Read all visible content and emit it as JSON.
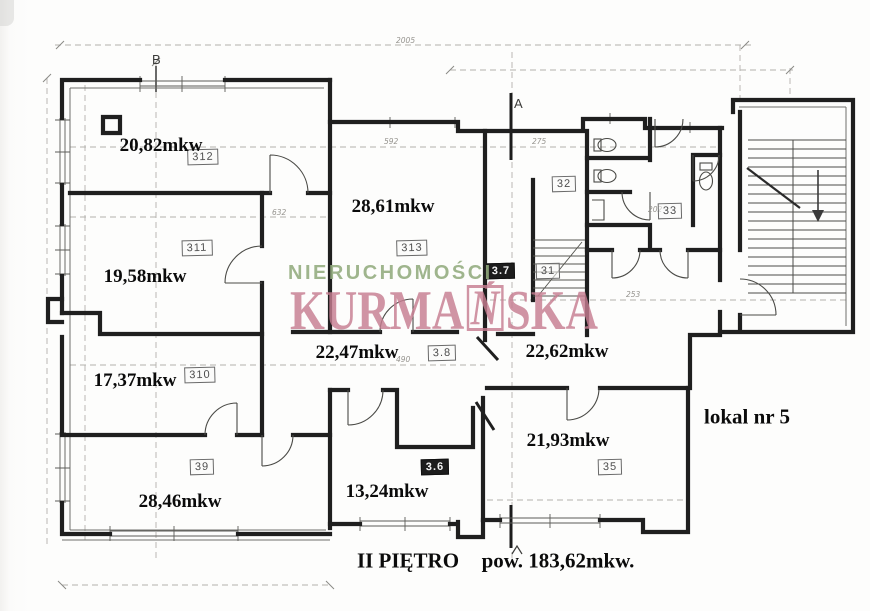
{
  "watermark": {
    "line1": "NIERUCHOMOŚCI",
    "line2_prefix": "KURMA",
    "line2_boxed": "Ń",
    "line2_suffix": "SKA",
    "color_green": "#93ac7e",
    "color_pink": "#c77e91"
  },
  "labels": {
    "floor": "II PIĘTRO",
    "total_area": "pow. 183,62mkw.",
    "unit": "lokal nr 5"
  },
  "areas": {
    "r312": "20,82mkw",
    "r313": "28,61mkw",
    "r311": "19,58mkw",
    "r310": "17,37mkw",
    "r38": "22,47mkw",
    "hall": "22,62mkw",
    "r35": "21,93mkw",
    "r39": "28,46mkw",
    "r36": "13,24mkw"
  },
  "room_tags": {
    "r312": "312",
    "r311": "311",
    "r310": "310",
    "r39": "39",
    "r313": "313",
    "r38": "3.8",
    "r36": "3.6",
    "r35": "35",
    "r32": "32",
    "r31": "31",
    "r33": "33",
    "r37": "3.7"
  },
  "axes": {
    "a": "A",
    "b": "B"
  },
  "dimensions": {
    "total_top": "2005",
    "d592": "592",
    "d275": "275",
    "d632": "632",
    "d490": "490",
    "d253": "253",
    "d202": "202"
  }
}
